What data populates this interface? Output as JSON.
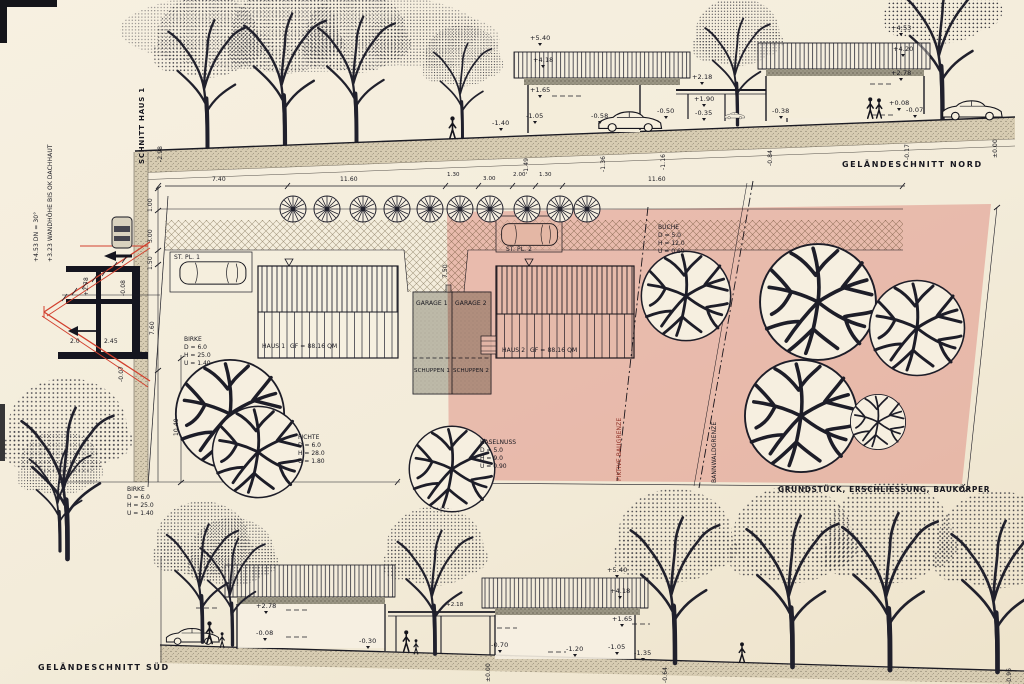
{
  "titles": {
    "north": "GELÄNDESCHNITT NORD",
    "south": "GELÄNDESCHNITT SÜD",
    "section": "SCHNITT HAUS 1",
    "plot_caption": "GRUNDSTÜCK, ERSCHLIESSUNG, BAUKÖRPER"
  },
  "north": {
    "marks": [
      "+5.40",
      "+4.18",
      "+1.65",
      "-1.05",
      "-1.40",
      "-0.58",
      "-0.50",
      "+2.18",
      "+1.90",
      "-0.35",
      "+4.53",
      "+4.20",
      "+2.78",
      "+0.08",
      "-0.07",
      "-0.38"
    ],
    "ground": [
      "-1.49",
      "-1.36",
      "-1.16",
      "-0.84",
      "-0.17",
      "±0.00"
    ]
  },
  "section": {
    "roof_note": "+4.53 DN = 30°",
    "wall_note": "+3.23 WANDHÖHE BIS OK DACHHAUT",
    "level_top": "+2.78",
    "level_floor": "-0.08",
    "level_base": "-0.07",
    "level_ground": "-2.98",
    "width_left": "2.0",
    "width_right": "2.45"
  },
  "plan": {
    "top_dims": [
      "7.40",
      "11.60",
      "1.30",
      "3.00",
      "2.00",
      "1.30",
      "11.60"
    ],
    "left_dims": [
      "1.00",
      "3.00",
      "1.50",
      "7.60",
      "10.40"
    ],
    "drive_dim": "7.50",
    "labels": {
      "stpl1": "ST. PL. 1",
      "stpl2": "ST. PL. 2",
      "garage1": "GARAGE 1",
      "garage2": "GARAGE 2",
      "schuppen1": "SCHUPPEN 1",
      "schuppen2": "SCHUPPEN 2",
      "haus1": "HAUS 1",
      "haus1_area": "GF = 88.16 QM",
      "haus2": "HAUS 2",
      "haus2_area": "GF = 88.16 QM",
      "fiktive_baugrenze": "FIKTIVE BAUGRENZE",
      "bannwaldgrenze": "BANNWALDGRENZE"
    },
    "trees": {
      "birke_top": {
        "name": "BIRKE",
        "d": "D = 6.0",
        "h": "H = 25.0",
        "u": "U = 1.40"
      },
      "birke_bottom": {
        "name": "BIRKE",
        "d": "D = 6.0",
        "h": "H = 25.0",
        "u": "U = 1.40"
      },
      "fichte": {
        "name": "FICHTE",
        "d": "D = 6.0",
        "h": "H = 28.0",
        "u": "U = 1.80"
      },
      "haselnuss": {
        "name": "HASELNUSS",
        "d": "D = 5.0",
        "h": "H = 9.0",
        "u": "U = 0.90"
      },
      "buche": {
        "name": "BUCHE",
        "d": "D = 5.0",
        "h": "H = 12.0",
        "u": "U = 0.60"
      }
    }
  },
  "south": {
    "marks": [
      "+5.40",
      "+4.18",
      "+1.65",
      "-1.05",
      "-1.35",
      "-1.20",
      "-0.70",
      "+2.78",
      "-0.08",
      "-0.30",
      "+2.18"
    ],
    "ground": [
      "±0.00",
      "-0.64",
      "-0.96"
    ]
  },
  "colors": {
    "plot_overlay_pink": "#dd8b80",
    "roof_line_red": "#d2402e",
    "ink": "#1b1b24",
    "paper": "#f3ecda"
  }
}
